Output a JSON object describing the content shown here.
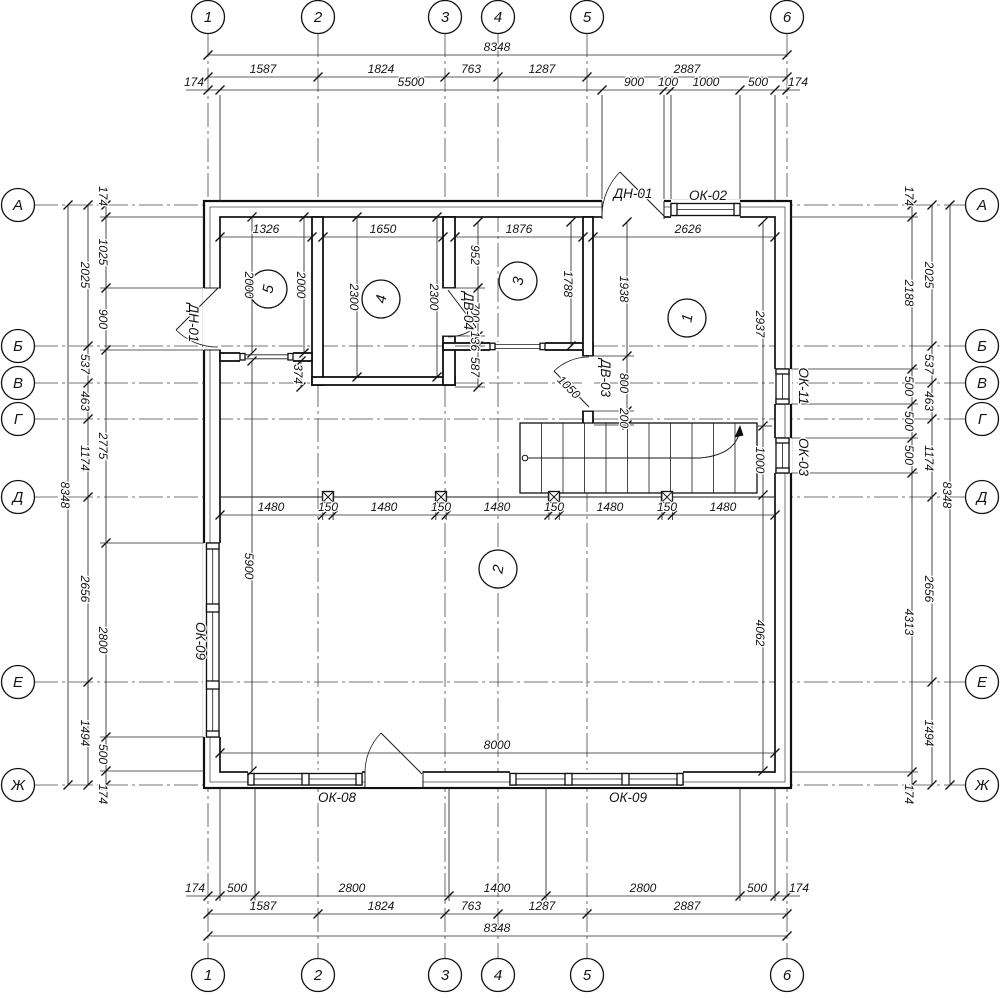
{
  "axes": {
    "cols": [
      "1",
      "2",
      "3",
      "4",
      "5",
      "6"
    ],
    "rows": [
      "А",
      "Б",
      "В",
      "Г",
      "Д",
      "Е",
      "Ж"
    ]
  },
  "dims": {
    "top_overall": "8348",
    "bottom_overall": "8348",
    "left_overall": "8348",
    "right_overall": "8348",
    "axis_spans": [
      "1587",
      "1824",
      "763",
      "1287",
      "2887"
    ],
    "top_chain": [
      "174",
      "5500",
      "900",
      "100",
      "1000",
      "500",
      "174"
    ],
    "bottom_chain": [
      "174",
      "500",
      "2800",
      "1400",
      "2800",
      "500",
      "174"
    ],
    "side_spans": [
      "2025",
      "537",
      "463",
      "1174",
      "2656",
      "1494"
    ],
    "left_chain": [
      "174",
      "1025",
      "900",
      "2775",
      "2800",
      "500",
      "174"
    ],
    "right_chain": [
      "174",
      "2188",
      "500",
      "500",
      "500",
      "4313",
      "174"
    ],
    "grid_row": [
      "1480",
      "150",
      "1480",
      "150",
      "1480",
      "150",
      "1480",
      "150",
      "1480"
    ],
    "room5": [
      "1326",
      "2000",
      "2000"
    ],
    "room4": [
      "1650",
      "2300",
      "2300"
    ],
    "room3": [
      "1876",
      "952",
      "1788"
    ],
    "room1": [
      "2626",
      "1938",
      "2937"
    ],
    "dv04": [
      "700",
      "136",
      "587"
    ],
    "dv03": [
      "800",
      "200"
    ],
    "extra": {
      "d374": "374",
      "d5900": "5900",
      "d8000": "8000",
      "d1000": "1000",
      "d4062": "4062",
      "leaf": "1050"
    }
  },
  "openings": {
    "dn01_top": "ДН-01",
    "ok02": "ОК-02",
    "dn01_left": "ДН-01",
    "dv04": "ДВ-04",
    "dv03": "ДВ-03",
    "ok11": "ОК-11",
    "ok03": "ОК-03",
    "ok09_left": "ОК-09",
    "ok08": "ОК-08",
    "ok09_bottom": "ОК-09"
  },
  "rooms": {
    "r1": "1",
    "r2": "2",
    "r3": "3",
    "r4": "4",
    "r5": "5"
  }
}
